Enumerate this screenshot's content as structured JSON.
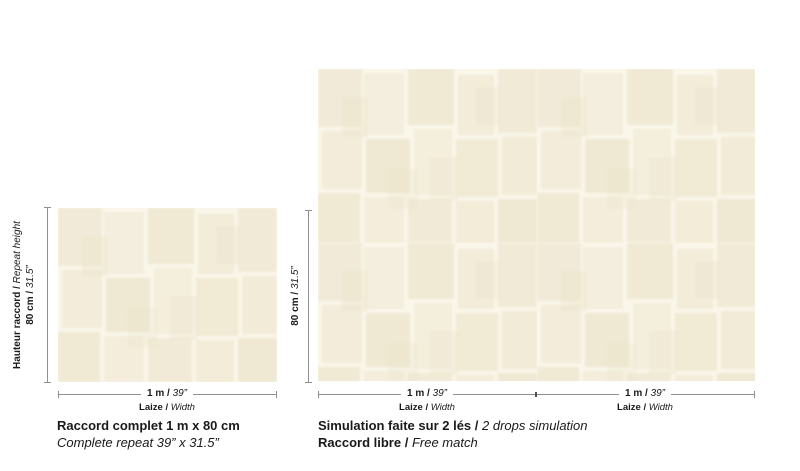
{
  "colors": {
    "line": "#8f8f8f",
    "text": "#1a1a1a",
    "wallpaper_base": "#faf6e9"
  },
  "left_panel": {
    "height_dimension": {
      "label_fr": "Hauteur raccord /",
      "label_en": "Repeat height",
      "value_metric": "80 cm /",
      "value_imperial": "31.5”"
    },
    "width_dimension": {
      "value_metric": "1 m /",
      "value_imperial": "39”",
      "label_fr": "Laize /",
      "label_en": "Width"
    },
    "caption": {
      "line1": "Raccord complet 1 m x 80 cm",
      "line2": "Complete repeat 39” x 31.5”"
    }
  },
  "right_panel": {
    "height_dimension": {
      "value_metric": "80 cm /",
      "value_imperial": "31.5”"
    },
    "drop1_width_dimension": {
      "value_metric": "1 m /",
      "value_imperial": "39”",
      "label_fr": "Laize /",
      "label_en": "Width"
    },
    "drop2_width_dimension": {
      "value_metric": "1 m /",
      "value_imperial": "39”",
      "label_fr": "Laize /",
      "label_en": "Width"
    },
    "caption": {
      "line1_fr": "Simulation faite sur 2 lés /",
      "line1_en": "2 drops simulation",
      "line2_fr": "Raccord libre /",
      "line2_en": "Free match"
    }
  }
}
